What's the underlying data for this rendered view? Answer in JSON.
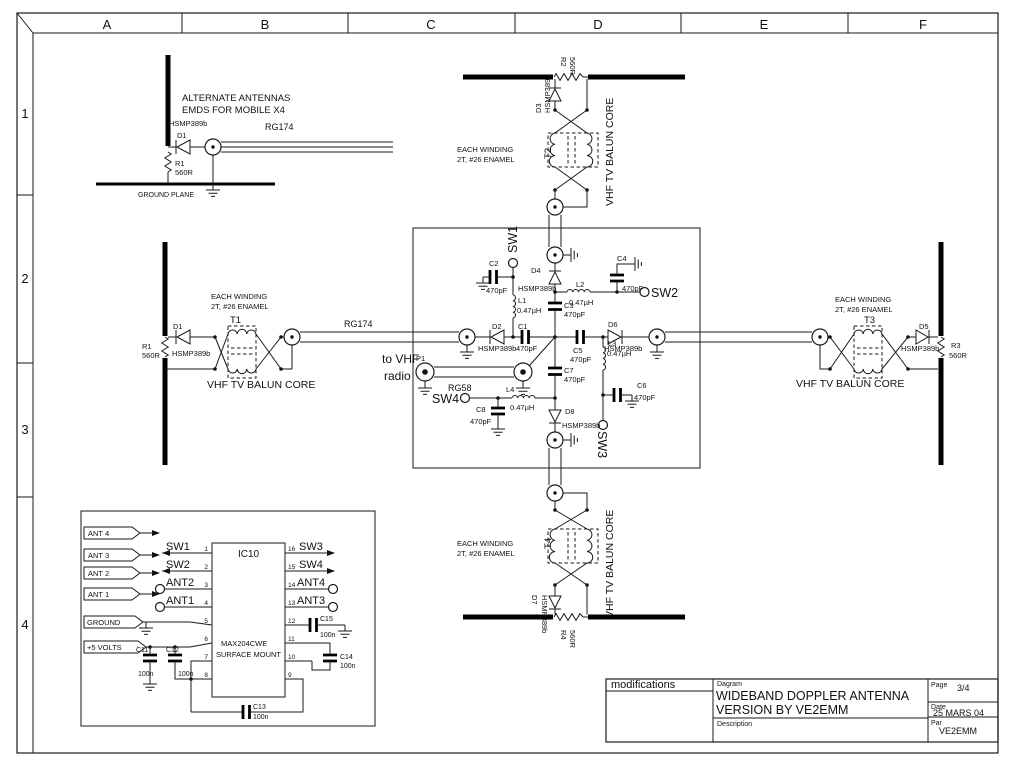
{
  "frame": {
    "cols": [
      "A",
      "B",
      "C",
      "D",
      "E",
      "F"
    ],
    "rows": [
      "1",
      "2",
      "3",
      "4"
    ]
  },
  "title_block": {
    "modifications": "modifications",
    "diagram_label": "Dagram",
    "title_line1": "WIDEBAND DOPPLER ANTENNA",
    "title_line2": "VERSION BY VE2EMM",
    "description_label": "Description",
    "page_label": "Page",
    "page": "3/4",
    "date_label": "Date",
    "date": "25 MARS 04",
    "par_label": "Par",
    "par": "VE2EMM"
  },
  "alt_circuit": {
    "note1": "ALTERNATE ANTENNAS",
    "note2": "EMDS FOR MOBILE  X4",
    "diode": "D1",
    "diode_part": "HSMP389b",
    "res": "R1",
    "res_val": "560R",
    "coax": "RG174",
    "ground": "GROUND PLANE"
  },
  "notes": {
    "each_winding": "EACH WINDING",
    "winding_spec": "2T, #26 ENAMEL",
    "balun": "VHF TV BALUN CORE",
    "to_vhf": "to VHF",
    "radio": "radio"
  },
  "arms": {
    "left": {
      "xfmr": "T1",
      "diode": "D1",
      "diode_part": "HSMP389b",
      "res": "R1",
      "res_val": "560R",
      "coax": "RG174"
    },
    "top": {
      "xfmr": "T2",
      "diode": "D3",
      "diode_part": "HSMP389b",
      "res": "R2",
      "res_val": "560R"
    },
    "right": {
      "xfmr": "T3",
      "diode": "D5",
      "diode_part": "HSMP389b",
      "res": "R3",
      "res_val": "560R"
    },
    "bottom": {
      "xfmr": "T4",
      "diode": "D7",
      "diode_part": "HSMP389b",
      "res": "R4",
      "res_val": "560R"
    }
  },
  "switch_box": {
    "sw1": "SW1",
    "sw2": "SW2",
    "sw3": "SW3",
    "sw4": "SW4",
    "p1": "P1",
    "rg58": "RG58",
    "c1": "C1",
    "c2": "C2",
    "c3": "C3",
    "c4": "C4",
    "c5": "C5",
    "c6": "C6",
    "c7": "C7",
    "c8": "C8",
    "cap_val": "470pF",
    "l1": "L1",
    "l2": "L2",
    "l3": "L3",
    "l4": "L4",
    "ind_val": "0.47µH",
    "d2": "D2",
    "d4": "D4",
    "d6": "D6",
    "d8": "D8",
    "diode_part": "HSMP389b"
  },
  "ic_block": {
    "ic": "IC10",
    "part": "MAX204CWE",
    "mount": "SURFACE MOUNT",
    "flags": [
      "ANT 4",
      "ANT 3",
      "ANT 2",
      "ANT 1",
      "GROUND",
      "+5 VOLTS"
    ],
    "pins_left": [
      {
        "n": "1",
        "label": "SW1"
      },
      {
        "n": "2",
        "label": "SW2"
      },
      {
        "n": "3",
        "label": "ANT2"
      },
      {
        "n": "4",
        "label": "ANT1"
      },
      {
        "n": "5",
        "label": ""
      },
      {
        "n": "6",
        "label": ""
      },
      {
        "n": "7",
        "label": ""
      },
      {
        "n": "8",
        "label": ""
      }
    ],
    "pins_right": [
      {
        "n": "16",
        "label": "SW3"
      },
      {
        "n": "15",
        "label": "SW4"
      },
      {
        "n": "14",
        "label": "ANT4"
      },
      {
        "n": "13",
        "label": "ANT3"
      },
      {
        "n": "12",
        "label": ""
      },
      {
        "n": "11",
        "label": ""
      },
      {
        "n": "10",
        "label": ""
      },
      {
        "n": "9",
        "label": ""
      }
    ],
    "caps": [
      {
        "name": "C11",
        "val": "100n"
      },
      {
        "name": "C12",
        "val": "100n"
      },
      {
        "name": "C13",
        "val": "100n"
      },
      {
        "name": "C14",
        "val": "100n"
      },
      {
        "name": "C15",
        "val": "100n"
      }
    ]
  }
}
